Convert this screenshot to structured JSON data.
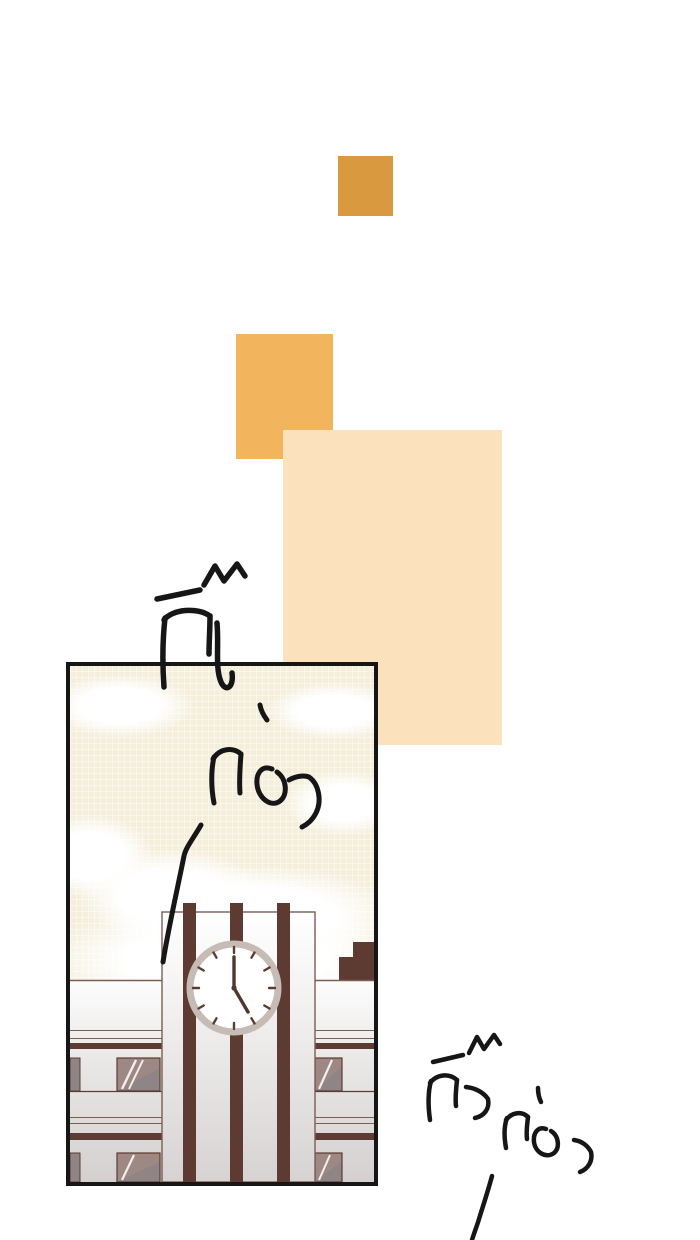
{
  "colors": {
    "accent_orange": "#d9993f",
    "accent_orange_light": "#f2b45c",
    "peach": "#fbe2bd",
    "ink": "#161616",
    "sky": "#f4eedb",
    "trim": "#5e3b32",
    "trim_line": "#7a5e52",
    "wall_light": "#fdfdfd",
    "wall_deep": "#d3d0cf",
    "glass": "#8f8486",
    "glass_warm": "#9e8884",
    "clock_ring": "#c6bbb5",
    "hand": "#4f372f"
  },
  "panel": {
    "scene_label": "clock tower building",
    "clock": {
      "time": "5:00"
    }
  },
  "sfx": {
    "top": {
      "word1": "กิ๊ง",
      "word2": "ก่อง"
    },
    "bottom": {
      "word1": "กิ๊ง",
      "word2": "ก่อง"
    }
  }
}
